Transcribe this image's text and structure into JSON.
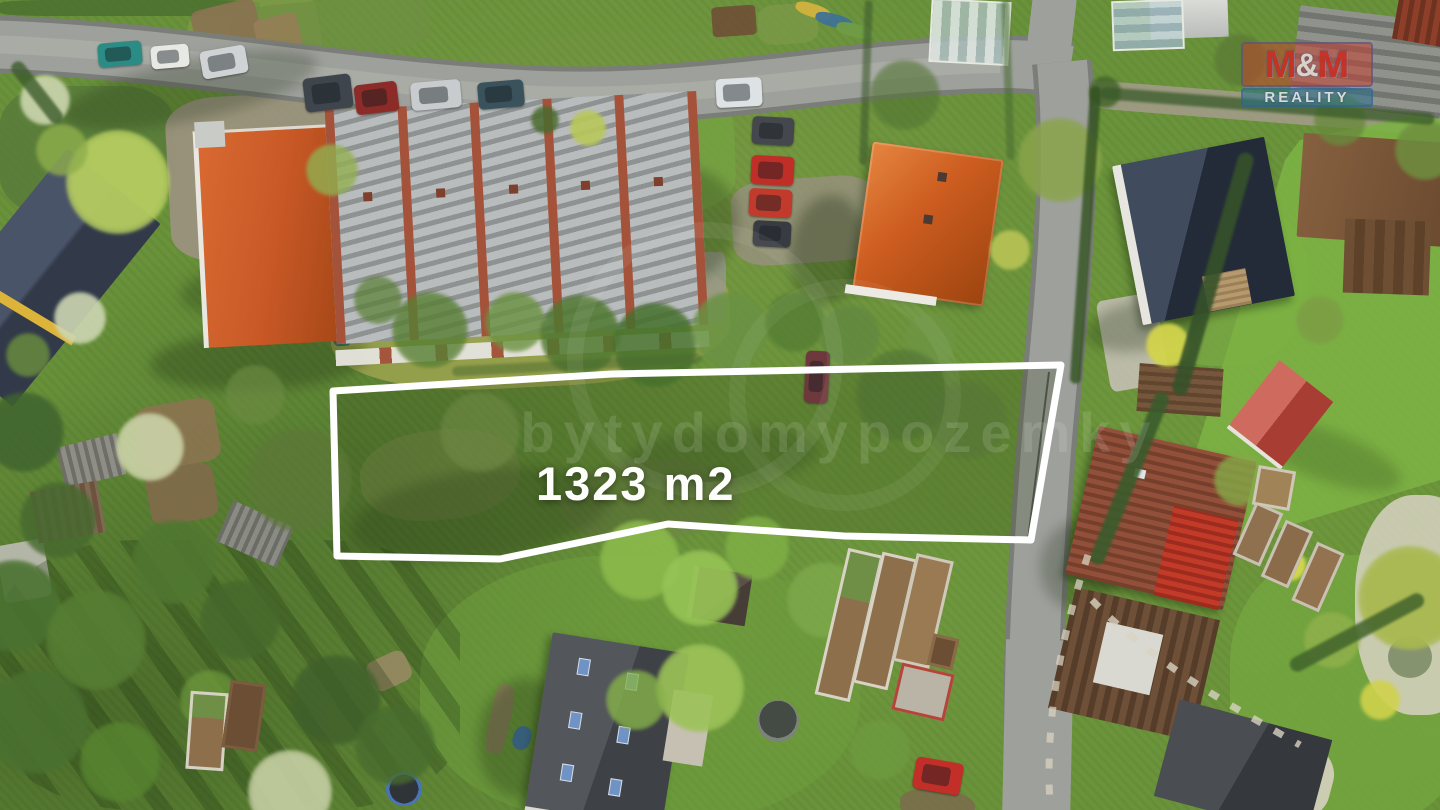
{
  "overlay": {
    "area_label": "1323 m2",
    "watermark_text": "bytydomypozemky",
    "logo": {
      "m1": "M",
      "amp": "&",
      "m2": "M",
      "word": "REALITY",
      "box_color": "#c63e2e",
      "bar_color": "#2a708c"
    }
  },
  "plot": {
    "outline_color": "#ffffff",
    "stroke_width": 7,
    "points": "333,391 612,374 1061,365 1031,540 844,536 668,524 500,559 337,556"
  },
  "scene": {
    "patches": [
      {
        "x": 0,
        "y": 0,
        "w": 260,
        "h": 16,
        "r": 0,
        "c": "#4a6e30",
        "o": 0.8,
        "br": "20%"
      },
      {
        "x": 190,
        "y": 0,
        "w": 130,
        "h": 70,
        "r": -10,
        "c": "#7e9a49",
        "o": 0.8,
        "br": "25%"
      },
      {
        "x": 230,
        "y": 0,
        "w": 200,
        "h": 55,
        "r": -5,
        "c": "#6f8f43",
        "o": 0.7,
        "br": "25%"
      },
      {
        "x": 712,
        "y": 6,
        "w": 44,
        "h": 30,
        "r": -4,
        "c": "#6e4f35",
        "o": 0.9,
        "br": "12%"
      },
      {
        "x": 758,
        "y": 4,
        "w": 60,
        "h": 40,
        "r": -4,
        "c": "#7d9a4a",
        "o": 0.7,
        "br": "30%"
      },
      {
        "x": 0,
        "y": 86,
        "w": 175,
        "h": 130,
        "r": 0,
        "c": "#55783a",
        "o": 0.7,
        "br": "30%"
      },
      {
        "x": 168,
        "y": 92,
        "w": 285,
        "h": 165,
        "r": -3,
        "c": "#9c9280",
        "o": 0.92,
        "br": "18%"
      },
      {
        "x": 430,
        "y": 98,
        "w": 100,
        "h": 248,
        "r": -2,
        "c": "#a1978a",
        "o": 0.85,
        "br": "12%"
      },
      {
        "x": 545,
        "y": 95,
        "w": 190,
        "h": 120,
        "r": -2,
        "c": "#76a342",
        "o": 0.8,
        "br": "30%"
      },
      {
        "x": 732,
        "y": 178,
        "w": 145,
        "h": 85,
        "r": -4,
        "c": "#99907f",
        "o": 0.8,
        "br": "25%"
      },
      {
        "x": 330,
        "y": 252,
        "w": 400,
        "h": 135,
        "r": -3,
        "c": "#9aa24e",
        "o": 0.9,
        "br": "40%"
      },
      {
        "x": 698,
        "y": 252,
        "w": 28,
        "h": 72,
        "r": 0,
        "c": "#99998f",
        "o": 0.8,
        "br": "20%"
      },
      {
        "x": 1138,
        "y": 196,
        "w": 170,
        "h": 170,
        "r": 0,
        "c": "#79a844",
        "o": 0.8,
        "br": "45%"
      },
      {
        "x": 1103,
        "y": 296,
        "w": 60,
        "h": 92,
        "r": -10,
        "c": "#c3bfb3",
        "o": 0.9,
        "br": "10%"
      },
      {
        "x": 1126,
        "y": 180,
        "w": 46,
        "h": 80,
        "r": -10,
        "c": "#bebaae",
        "o": 0.85,
        "br": "10%"
      },
      {
        "x": 1092,
        "y": 94,
        "w": 352,
        "h": 28,
        "r": 4.5,
        "c": "#a59c8d",
        "o": 0.85,
        "br": "8%"
      },
      {
        "x": 138,
        "y": 402,
        "w": 80,
        "h": 64,
        "r": -10,
        "c": "#8c7351",
        "o": 0.9,
        "br": "20%"
      },
      {
        "x": 148,
        "y": 466,
        "w": 68,
        "h": 56,
        "r": -10,
        "c": "#826a4b",
        "o": 0.9,
        "br": "20%"
      },
      {
        "x": 194,
        "y": 4,
        "w": 66,
        "h": 50,
        "r": -14,
        "c": "#8a7252",
        "o": 0.9,
        "br": "15%"
      },
      {
        "x": 256,
        "y": 16,
        "w": 44,
        "h": 36,
        "r": -14,
        "c": "#967e58",
        "o": 0.9,
        "br": "15%"
      },
      {
        "x": 330,
        "y": 296,
        "w": 22,
        "h": 50,
        "r": -4,
        "c": "#2d6b64",
        "o": 0.9,
        "br": "30%"
      },
      {
        "x": 420,
        "y": 555,
        "w": 440,
        "h": 270,
        "r": 0,
        "c": "#6f9e3e",
        "o": 0.55,
        "br": "45%"
      },
      {
        "x": 1230,
        "y": 555,
        "w": 240,
        "h": 270,
        "r": 0,
        "c": "#74a63f",
        "o": 0.8,
        "br": "40%"
      },
      {
        "x": 1355,
        "y": 495,
        "w": 130,
        "h": 220,
        "r": 0,
        "c": "#d8d2c2",
        "o": 0.85,
        "br": "45%"
      },
      {
        "x": 1388,
        "y": 636,
        "w": 44,
        "h": 42,
        "r": 0,
        "c": "#76855f",
        "o": 0.8,
        "br": "50%"
      },
      {
        "x": 1218,
        "y": 732,
        "w": 115,
        "h": 85,
        "r": 15,
        "c": "#d6d0c0",
        "o": 0.9,
        "br": "40%"
      },
      {
        "x": 900,
        "y": 790,
        "w": 75,
        "h": 32,
        "r": 6,
        "c": "#7c694d",
        "o": 0.8,
        "br": "40%"
      },
      {
        "x": 360,
        "y": 430,
        "w": 160,
        "h": 90,
        "r": -6,
        "c": "#79894a",
        "o": 0.5,
        "br": "45%"
      },
      {
        "x": 560,
        "y": 460,
        "w": 180,
        "h": 80,
        "r": -4,
        "c": "#70834a",
        "o": 0.45,
        "br": "45%"
      },
      {
        "x": 0,
        "y": 542,
        "w": 48,
        "h": 58,
        "r": -10,
        "c": "#bdbdb4",
        "o": 0.9,
        "br": "12%"
      },
      {
        "x": 490,
        "y": 684,
        "w": 20,
        "h": 70,
        "r": 12,
        "c": "#8a7a5c",
        "o": 0.85,
        "br": "30%"
      },
      {
        "x": 513,
        "y": 726,
        "w": 18,
        "h": 24,
        "r": 20,
        "c": "#3e6fae",
        "o": 0.9,
        "br": "45%"
      },
      {
        "x": 368,
        "y": 655,
        "w": 42,
        "h": 32,
        "r": -25,
        "c": "#9b8a66",
        "o": 0.85,
        "br": "25%"
      },
      {
        "x": 1040,
        "y": 430,
        "w": 16,
        "h": 14,
        "r": 0,
        "c": "#cfcabc",
        "o": 0.9,
        "br": "50%"
      },
      {
        "x": 1064,
        "y": 250,
        "w": 10,
        "h": 10,
        "r": 0,
        "c": "#e8e8e4",
        "o": 0.95,
        "br": "50%"
      },
      {
        "x": 0,
        "y": 540,
        "w": 460,
        "h": 270,
        "r": 0,
        "c": "",
        "o": 1,
        "br": "30%",
        "bg": "repeating-linear-gradient(55deg, rgba(25,45,15,.26) 0 16px, transparent 16px 42px)"
      },
      {
        "x": 795,
        "y": 4,
        "w": 36,
        "h": 13,
        "r": 18,
        "c": "#d2b23e",
        "o": 0.95,
        "br": "40%"
      },
      {
        "x": 815,
        "y": 14,
        "w": 38,
        "h": 13,
        "r": 15,
        "c": "#3f7296",
        "o": 0.95,
        "br": "40%"
      },
      {
        "x": 836,
        "y": 24,
        "w": 38,
        "h": 13,
        "r": 14,
        "c": "#6f9c45",
        "o": 0.95,
        "br": "40%"
      }
    ],
    "shadows": [
      {
        "x": 150,
        "y": 330,
        "w": 220,
        "h": 60,
        "r": -3,
        "o": 0.3
      },
      {
        "x": 790,
        "y": 195,
        "w": 75,
        "h": 110,
        "r": 8,
        "o": 0.33
      },
      {
        "x": 1085,
        "y": 300,
        "w": 120,
        "h": 50,
        "r": -10,
        "o": 0.28
      },
      {
        "x": 478,
        "y": 678,
        "w": 90,
        "h": 120,
        "r": 8,
        "o": 0.28
      },
      {
        "x": 1040,
        "y": 520,
        "w": 80,
        "h": 90,
        "r": 10,
        "o": 0.26
      },
      {
        "x": 350,
        "y": 470,
        "w": 260,
        "h": 90,
        "r": -8,
        "o": 0.22
      },
      {
        "x": 180,
        "y": 250,
        "w": 260,
        "h": 70,
        "r": -5,
        "o": 0.26
      },
      {
        "x": 620,
        "y": 428,
        "w": 200,
        "h": 60,
        "r": -5,
        "o": 0.18
      },
      {
        "x": 1245,
        "y": 430,
        "w": 160,
        "h": 50,
        "r": 20,
        "o": 0.2
      },
      {
        "x": 600,
        "y": 168,
        "w": 140,
        "h": 120,
        "r": -25,
        "o": 0.28
      },
      {
        "x": 60,
        "y": 60,
        "w": 260,
        "h": 60,
        "r": -12,
        "o": 0.25
      }
    ],
    "trees": [
      {
        "x": 118,
        "y": 182,
        "d": 104,
        "c": "#b5cc60",
        "o": 0.95
      },
      {
        "x": 62,
        "y": 150,
        "d": 52,
        "c": "#8fae4c",
        "o": 0.8
      },
      {
        "x": 45,
        "y": 100,
        "d": 50,
        "c": "#cdd6ae",
        "o": 0.9
      },
      {
        "x": 80,
        "y": 318,
        "d": 52,
        "c": "#cdd6b2",
        "o": 0.9
      },
      {
        "x": 28,
        "y": 355,
        "d": 44,
        "c": "#6b8f3d",
        "o": 0.8
      },
      {
        "x": 150,
        "y": 447,
        "d": 68,
        "c": "#ccd3a8",
        "o": 0.9
      },
      {
        "x": 24,
        "y": 432,
        "d": 80,
        "c": "#3f632e",
        "o": 0.85
      },
      {
        "x": 58,
        "y": 520,
        "d": 76,
        "c": "#47692f",
        "o": 0.85
      },
      {
        "x": 14,
        "y": 606,
        "d": 92,
        "c": "#4a7130",
        "o": 0.9
      },
      {
        "x": 96,
        "y": 640,
        "d": 100,
        "c": "#567d33",
        "o": 0.9
      },
      {
        "x": 36,
        "y": 722,
        "d": 104,
        "c": "#4a7030",
        "o": 0.9
      },
      {
        "x": 174,
        "y": 562,
        "d": 84,
        "c": "#507731",
        "o": 0.85
      },
      {
        "x": 240,
        "y": 620,
        "d": 80,
        "c": "#45682c",
        "o": 0.8
      },
      {
        "x": 120,
        "y": 762,
        "d": 80,
        "c": "#57842f",
        "o": 0.85
      },
      {
        "x": 290,
        "y": 792,
        "d": 84,
        "c": "#c6d0a4",
        "o": 0.9
      },
      {
        "x": 210,
        "y": 700,
        "d": 60,
        "c": "#6f9a3d",
        "o": 0.7
      },
      {
        "x": 336,
        "y": 700,
        "d": 90,
        "c": "#3f5f2b",
        "o": 0.8
      },
      {
        "x": 395,
        "y": 745,
        "d": 80,
        "c": "#486c2e",
        "o": 0.8
      },
      {
        "x": 300,
        "y": 480,
        "d": 104,
        "c": "#5d7838",
        "o": 0.75
      },
      {
        "x": 255,
        "y": 395,
        "d": 60,
        "c": "#6b8a41",
        "o": 0.7
      },
      {
        "x": 430,
        "y": 330,
        "d": 76,
        "c": "#577f33",
        "o": 0.8
      },
      {
        "x": 515,
        "y": 322,
        "d": 60,
        "c": "#6a9140",
        "o": 0.8
      },
      {
        "x": 580,
        "y": 335,
        "d": 80,
        "c": "#4f7830",
        "o": 0.85
      },
      {
        "x": 655,
        "y": 345,
        "d": 84,
        "c": "#45702c",
        "o": 0.85
      },
      {
        "x": 730,
        "y": 330,
        "d": 76,
        "c": "#699243",
        "o": 0.85
      },
      {
        "x": 795,
        "y": 322,
        "d": 60,
        "c": "#557d33",
        "o": 0.8
      },
      {
        "x": 850,
        "y": 335,
        "d": 60,
        "c": "#618840",
        "o": 0.8
      },
      {
        "x": 930,
        "y": 340,
        "d": 52,
        "c": "#6e9544",
        "o": 0.75
      },
      {
        "x": 1060,
        "y": 160,
        "d": 84,
        "c": "#8aa44b",
        "o": 0.85
      },
      {
        "x": 1010,
        "y": 250,
        "d": 40,
        "c": "#b9c455",
        "o": 0.9
      },
      {
        "x": 640,
        "y": 560,
        "d": 80,
        "c": "#8cba4b",
        "o": 0.9
      },
      {
        "x": 700,
        "y": 588,
        "d": 76,
        "c": "#97c455",
        "o": 0.9
      },
      {
        "x": 757,
        "y": 548,
        "d": 64,
        "c": "#7fae45",
        "o": 0.85
      },
      {
        "x": 700,
        "y": 688,
        "d": 88,
        "c": "#9cc258",
        "o": 0.92
      },
      {
        "x": 636,
        "y": 700,
        "d": 60,
        "c": "#86b24a",
        "o": 0.8
      },
      {
        "x": 825,
        "y": 600,
        "d": 76,
        "c": "#7da84a",
        "o": 0.85
      },
      {
        "x": 880,
        "y": 750,
        "d": 60,
        "c": "#6f9c40",
        "o": 0.7
      },
      {
        "x": 1410,
        "y": 598,
        "d": 104,
        "c": "#a9b950",
        "o": 0.95
      },
      {
        "x": 1332,
        "y": 640,
        "d": 56,
        "c": "#90b04c",
        "o": 0.85
      },
      {
        "x": 1290,
        "y": 565,
        "d": 32,
        "c": "#d6d84e",
        "o": 0.95
      },
      {
        "x": 1168,
        "y": 345,
        "d": 44,
        "c": "#d3d44c",
        "o": 0.95
      },
      {
        "x": 1380,
        "y": 700,
        "d": 40,
        "c": "#cfd24c",
        "o": 0.9
      },
      {
        "x": 588,
        "y": 128,
        "d": 36,
        "c": "#b9c85a",
        "o": 0.9
      },
      {
        "x": 545,
        "y": 120,
        "d": 28,
        "c": "#4a6b2f",
        "o": 0.85
      },
      {
        "x": 1105,
        "y": 92,
        "d": 32,
        "c": "#44652c",
        "o": 0.85
      },
      {
        "x": 332,
        "y": 170,
        "d": 52,
        "c": "#92b050",
        "o": 0.8
      },
      {
        "x": 378,
        "y": 300,
        "d": 48,
        "c": "#587e33",
        "o": 0.7
      },
      {
        "x": 480,
        "y": 432,
        "d": 80,
        "c": "#748e48",
        "o": 0.5
      },
      {
        "x": 902,
        "y": 395,
        "d": 92,
        "c": "#4c6d33",
        "o": 0.55
      },
      {
        "x": 968,
        "y": 420,
        "d": 80,
        "c": "#567439",
        "o": 0.5
      },
      {
        "x": 1240,
        "y": 480,
        "d": 52,
        "c": "#85aa48",
        "o": 0.8
      },
      {
        "x": 1320,
        "y": 320,
        "d": 48,
        "c": "#7d9c45",
        "o": 0.8
      },
      {
        "x": 1425,
        "y": 150,
        "d": 60,
        "c": "#6f8f3f",
        "o": 0.85
      },
      {
        "x": 1240,
        "y": 60,
        "d": 52,
        "c": "#5d7c36",
        "o": 0.85
      },
      {
        "x": 1340,
        "y": 120,
        "d": 52,
        "c": "#69893c",
        "o": 0.8
      },
      {
        "x": 905,
        "y": 95,
        "d": 70,
        "c": "#527433",
        "o": 0.6
      }
    ],
    "strips": [
      {
        "x": 1205,
        "y": 148,
        "w": 16,
        "h": 252,
        "r": 16,
        "c": "#36522a",
        "o": 0.9
      },
      {
        "x": 1122,
        "y": 386,
        "w": 15,
        "h": 185,
        "r": 22,
        "c": "#3a5c2c",
        "o": 0.9
      },
      {
        "x": 1080,
        "y": 86,
        "w": 11,
        "h": 298,
        "r": 4,
        "c": "#31511f",
        "o": 0.8
      },
      {
        "x": 1282,
        "y": 625,
        "w": 150,
        "h": 15,
        "r": -28,
        "c": "#41632c",
        "o": 0.85
      },
      {
        "x": 1100,
        "y": 100,
        "w": 335,
        "h": 12,
        "r": 4.5,
        "c": "#3a5a2a",
        "o": 0.75
      },
      {
        "x": 862,
        "y": 0,
        "w": 8,
        "h": 165,
        "r": 2,
        "c": "#3f5c2e",
        "o": 0.6
      },
      {
        "x": 1004,
        "y": 0,
        "w": 8,
        "h": 160,
        "r": -2,
        "c": "#486b31",
        "o": 0.55
      },
      {
        "x": 30,
        "y": 55,
        "w": 14,
        "h": 75,
        "r": -38,
        "c": "#3c5c2c",
        "o": 0.8
      },
      {
        "x": 452,
        "y": 360,
        "w": 250,
        "h": 10,
        "r": -3,
        "c": "#4a6a2f",
        "o": 0.5
      }
    ],
    "cars": [
      {
        "x": 98,
        "y": 42,
        "w": 44,
        "h": 24,
        "r": -5,
        "c": "#2a8c84"
      },
      {
        "x": 151,
        "y": 45,
        "w": 38,
        "h": 23,
        "r": -5,
        "c": "#e8e8e5"
      },
      {
        "x": 201,
        "y": 48,
        "w": 46,
        "h": 28,
        "r": -10,
        "c": "#d0d3d5"
      },
      {
        "x": 304,
        "y": 76,
        "w": 48,
        "h": 34,
        "r": -7,
        "c": "#3f454c"
      },
      {
        "x": 355,
        "y": 83,
        "w": 43,
        "h": 30,
        "r": -7,
        "c": "#8c2b27"
      },
      {
        "x": 411,
        "y": 81,
        "w": 50,
        "h": 28,
        "r": -5,
        "c": "#c9ccce"
      },
      {
        "x": 478,
        "y": 81,
        "w": 46,
        "h": 27,
        "r": -5,
        "c": "#39525c"
      },
      {
        "x": 716,
        "y": 78,
        "w": 46,
        "h": 29,
        "r": -3,
        "c": "#dde2e4"
      },
      {
        "x": 752,
        "y": 117,
        "w": 42,
        "h": 28,
        "r": 3,
        "c": "#44484e"
      },
      {
        "x": 751,
        "y": 156,
        "w": 43,
        "h": 29,
        "r": 3,
        "c": "#bf2f27"
      },
      {
        "x": 749,
        "y": 189,
        "w": 43,
        "h": 28,
        "r": 3,
        "c": "#c23a2c"
      },
      {
        "x": 753,
        "y": 221,
        "w": 38,
        "h": 26,
        "r": 3,
        "c": "#383c42"
      },
      {
        "x": 805,
        "y": 351,
        "w": 24,
        "h": 52,
        "r": 3,
        "c": "#6d393c"
      },
      {
        "x": 914,
        "y": 760,
        "w": 48,
        "h": 32,
        "r": 10,
        "c": "#c22f28"
      }
    ],
    "planters": [
      {
        "x": 831,
        "y": 550,
        "w": 36,
        "h": 150,
        "r": 13,
        "f": "#d8d3c5",
        "c": "#8d6f4c",
        "c2": "#6f8f47"
      },
      {
        "x": 867,
        "y": 554,
        "w": 36,
        "h": 134,
        "r": 13,
        "f": "#d8d3c5",
        "c": "#8d6f4c"
      },
      {
        "x": 904,
        "y": 556,
        "w": 38,
        "h": 110,
        "r": 13,
        "f": "#cfc9ba",
        "c": "#9a7a52"
      },
      {
        "x": 930,
        "y": 636,
        "w": 26,
        "h": 32,
        "r": 13,
        "f": "#8a6b47",
        "c": "#6b4e33"
      },
      {
        "x": 896,
        "y": 668,
        "w": 54,
        "h": 48,
        "r": 13,
        "f": "#b5443a",
        "c": "#b9b4a6"
      },
      {
        "x": 1243,
        "y": 505,
        "w": 30,
        "h": 58,
        "r": 24,
        "f": "#c9c2b2",
        "c": "#8f7150"
      },
      {
        "x": 1272,
        "y": 523,
        "w": 30,
        "h": 62,
        "r": 24,
        "f": "#c9c2b2",
        "c": "#8a6c4b"
      },
      {
        "x": 1303,
        "y": 545,
        "w": 30,
        "h": 64,
        "r": 24,
        "f": "#c9c2b2",
        "c": "#93734f"
      },
      {
        "x": 1255,
        "y": 468,
        "w": 38,
        "h": 40,
        "r": 10,
        "f": "#cfc8b8",
        "c": "#a08457"
      },
      {
        "x": 188,
        "y": 692,
        "w": 38,
        "h": 78,
        "r": 4,
        "f": "#d6d1c3",
        "c": "#8d6f4c",
        "c2": "#6f8f47"
      },
      {
        "x": 226,
        "y": 682,
        "w": 36,
        "h": 68,
        "r": 8,
        "f": "#7a5c3e",
        "c": "#6b4e33"
      }
    ]
  }
}
